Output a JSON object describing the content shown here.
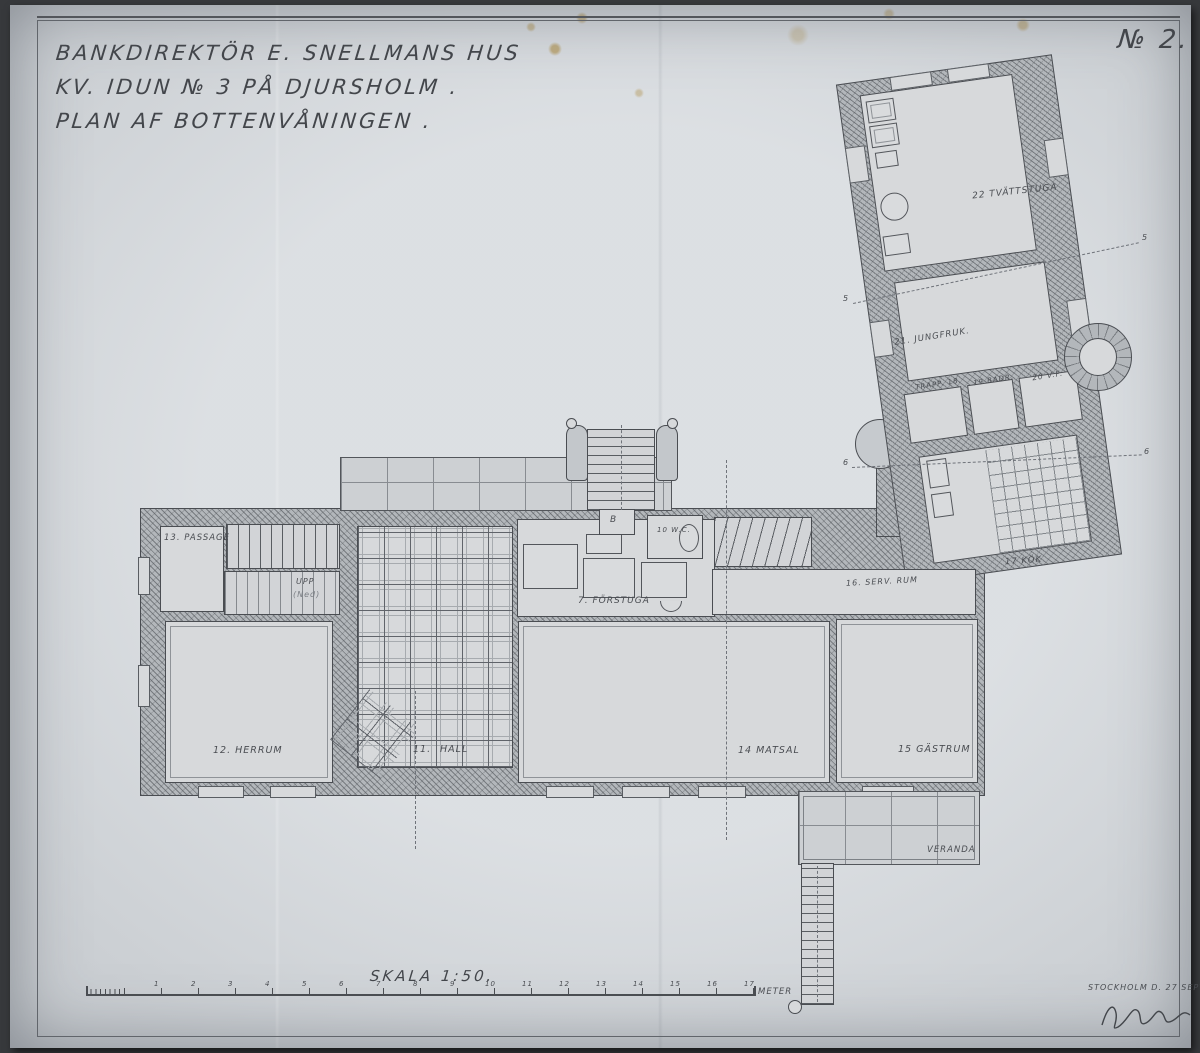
{
  "document": {
    "title_line1": "BANKDIREKTÖR  E.  SNELLMANS  HUS",
    "title_line2": "KV. IDUN  № 3  PÅ  DJURSHOLM .",
    "title_line3": "PLAN  AF  BOTTENVÅNINGEN  .",
    "sheet_number": "№ 2.",
    "scale_label": "SKALA   1:50.",
    "meter_label": "METER",
    "place_date": "STOCKHOLM D. 27 SEPT. 97."
  },
  "scale_ticks": [
    "1",
    "2",
    "3",
    "4",
    "5",
    "6",
    "7",
    "8",
    "9",
    "10",
    "11",
    "12",
    "13",
    "14",
    "15",
    "16",
    "17"
  ],
  "rooms": {
    "passage13": "13. PASSAGE",
    "upp": "UPP",
    "ned": "(Ned)",
    "herrum12": "12. HERRUM",
    "hall11_no": "11.",
    "hall11": "HALL",
    "forstuga7": "7. FÖRSTUGA",
    "b_mark": "B",
    "wc10": "10 W.C.",
    "matsal14": "14  MATSAL",
    "gastrum15": "15  GÄSTRUM",
    "servrum16": "16. SERV. RUM",
    "kok17": "17  KÖK",
    "trapp18": "TRAPP. 18.",
    "bad19": "19 BADR.",
    "vf20": "20 V.F.",
    "jungfruk21": "21. JUNGFRUK.",
    "tvattstuga22": "22  TVÄTTSTUGA",
    "veranda": "VERANDA"
  },
  "axes": {
    "s5": "5",
    "s6": "6"
  },
  "colors": {
    "paper": "#c6cace",
    "ink": "#43464b",
    "wall_poche": "#b3b7bb",
    "stain": "#a88434"
  }
}
